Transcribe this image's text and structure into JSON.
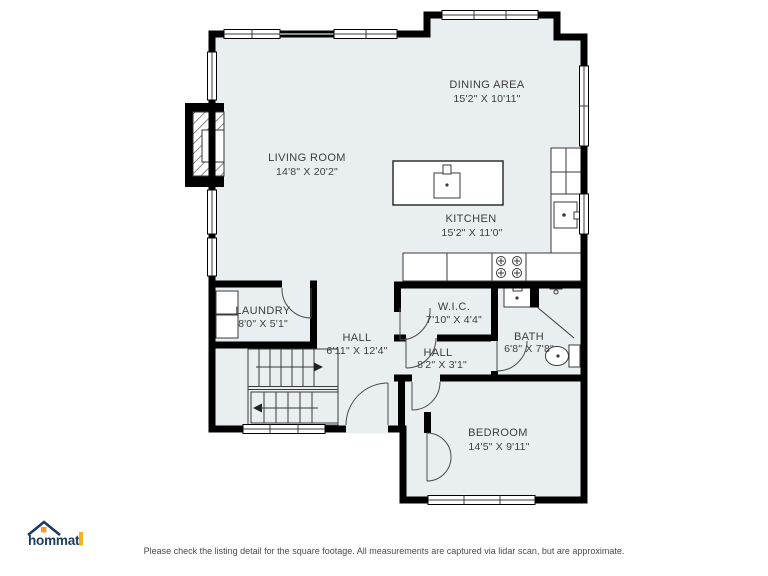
{
  "floorplan": {
    "floor_fill": "#e9eef1",
    "wall_color": "#000000",
    "rooms": [
      {
        "id": "living",
        "name": "LIVING ROOM",
        "dims": "14'8\" X 20'2\""
      },
      {
        "id": "dining",
        "name": "DINING AREA",
        "dims": "15'2\" X 10'11\""
      },
      {
        "id": "kitchen",
        "name": "KITCHEN",
        "dims": "15'2\" X 11'0\""
      },
      {
        "id": "laundry",
        "name": "LAUNDRY",
        "dims": "8'0\" X 5'1\""
      },
      {
        "id": "hall",
        "name": "HALL",
        "dims": "6'11\" X 12'4\""
      },
      {
        "id": "wic",
        "name": "W.I.C.",
        "dims": "7'10\" X 4'4\""
      },
      {
        "id": "hall2",
        "name": "HALL",
        "dims": "8'2\" X 3'1\""
      },
      {
        "id": "bath",
        "name": "BATH",
        "dims": "6'8\" X 7'8\""
      },
      {
        "id": "bedroom",
        "name": "BEDROOM",
        "dims": "14'5\" X 9'11\""
      }
    ]
  },
  "branding": {
    "logo_text": "hommati",
    "logo_color": "#1c3a5e",
    "accent_orange": "#ee9f2e",
    "accent_yellow": "#f2b41f"
  },
  "footer": {
    "disclaimer": "Please check the listing detail for the square footage. All measurements are captured via lidar scan, but are approximate."
  }
}
